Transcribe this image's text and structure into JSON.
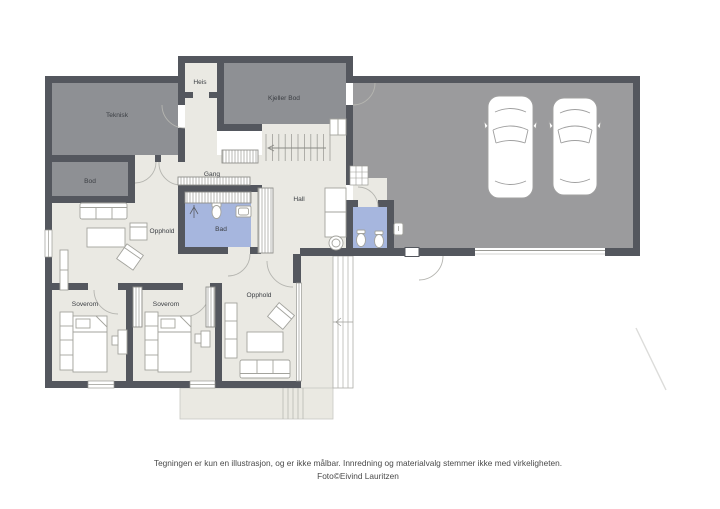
{
  "colors": {
    "wall": "#54575e",
    "floor": "#eae9e3",
    "storage_floor": "#8e9094",
    "garage_floor": "#9b9b9d",
    "bath_floor": "#a6b6de",
    "terrace_floor": "#eae9e2",
    "background": "#ffffff"
  },
  "rooms": {
    "heis": {
      "label": "Heis"
    },
    "teknisk": {
      "label": "Teknisk"
    },
    "kjeller_bod": {
      "label": "Kjeller Bod"
    },
    "bod": {
      "label": "Bod"
    },
    "gang": {
      "label": "Gang"
    },
    "bad": {
      "label": "Bad"
    },
    "hall": {
      "label": "Hall"
    },
    "opphold_upper": {
      "label": "Opphold"
    },
    "soverom_left": {
      "label": "Soverom"
    },
    "soverom_mid": {
      "label": "Soverom"
    },
    "opphold_lower": {
      "label": "Opphold"
    }
  },
  "footer": {
    "line1": "Tegningen er kun en illustrasjon, og er ikke målbar. Innredning og materialvalg stemmer ikke med virkeligheten.",
    "line2": "Foto©Eivind Lauritzen"
  }
}
